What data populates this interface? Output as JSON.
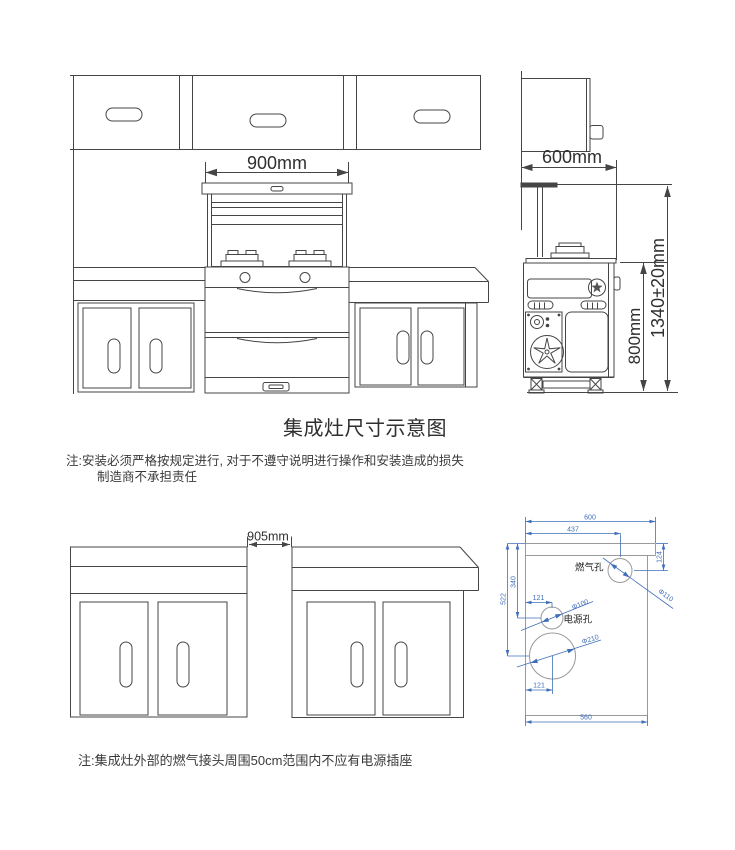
{
  "title": "集成灶尺寸示意图",
  "front_elevation": {
    "stove_width": "900mm"
  },
  "side_view": {
    "cabinet_depth": "600mm",
    "counter_height": "800mm",
    "overall_height": "1340±20mm"
  },
  "install_note": {
    "line1": "注:安装必须严格按规定进行, 对于不遵守说明进行操作和安装造成的损失",
    "line2": "制造商不承担责任"
  },
  "gap_view": {
    "opening_width": "905mm"
  },
  "cutout_view": {
    "top_width": "600",
    "gas_hole_x": "437",
    "gas_hole_y": "124",
    "big_hole_y": "522",
    "power_hole_y": "340",
    "power_hole_x": "121",
    "big_hole_x": "121",
    "bottom_width": "560",
    "gas_hole_label": "燃气孔",
    "gas_hole_dia": "Φ110",
    "power_hole_label": "电源孔",
    "power_hole_dia": "Φ100",
    "big_hole_dia": "Φ210"
  },
  "safety_note": "注:集成灶外部的燃气接头周围50cm范围内不应有电源插座",
  "colors": {
    "line": "#454545",
    "dim_blue": "#3f6fba",
    "outline_gray": "#9a9a9a"
  }
}
